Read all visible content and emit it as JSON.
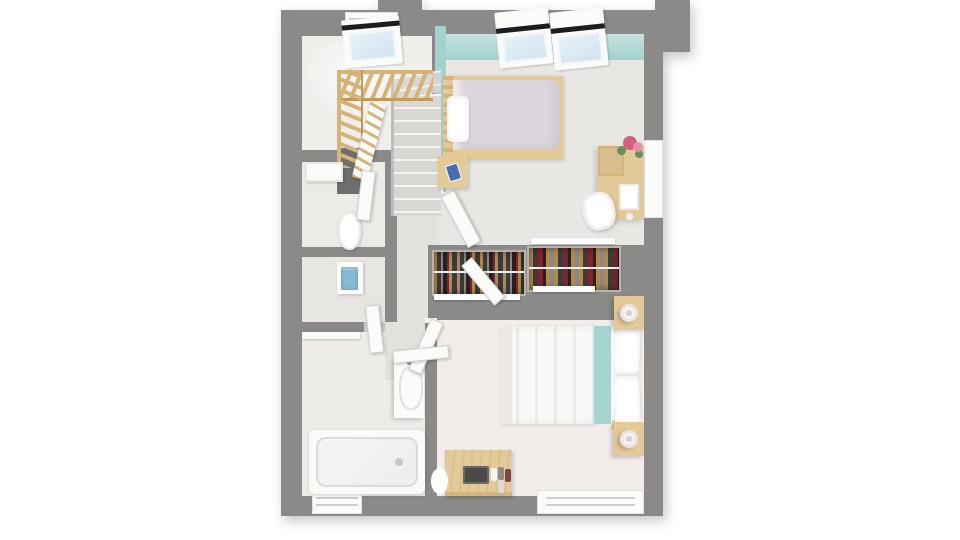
{
  "scene": {
    "type": "3d-floor-plan-top-view",
    "description": "Top-down 3D rendering of an upper floor: staircase, two bedrooms, WC, washroom, bathroom, hallway and built-in wardrobes",
    "background": "#ffffff"
  },
  "colors": {
    "page_bg": "#ffffff",
    "wall": "#8b8a88",
    "wall_void": "#6f6e6c",
    "teal": "#a2d2cd",
    "teal_light": "#c6e2de",
    "floor_stair": "#efeeeb",
    "floor_bed1": "#e9e7e4",
    "floor_hall": "#e2e1de",
    "floor_wc": "#ecebe8",
    "floor_wash": "#e8e6e3",
    "floor_bath": "#edece9",
    "floor_master": "#f2ecea",
    "wood": "#e4ca98",
    "wood_mid": "#d6b377",
    "wood_dark": "#c09a58",
    "white_obj": "#fbfbfa",
    "glass": "#cfe3ef",
    "sash_dark": "#1d1d1d",
    "tread": "#d8d7d4",
    "tread_edge": "#f4f4f2",
    "lilac": "#dcd5db",
    "duvet_white": "#f9f8f6",
    "blanket_teal": "#a6d4d2",
    "towel_blue": "#85bcd8",
    "phone_blue": "#4a6cb3",
    "flower_pink": "#d26180",
    "flower_pink2": "#e591a7",
    "leaf_green": "#67905c",
    "clothes_tan": "#b08a52",
    "clothes_dark": "#3e3a37",
    "clothes_red": "#822430",
    "clothes_gray": "#8d8781",
    "clothes_black": "#262220"
  },
  "rooms": [
    {
      "name": "staircase-room",
      "items": [
        "skylight",
        "wood-railing",
        "winding-stairs"
      ]
    },
    {
      "name": "wc",
      "items": [
        "toilet",
        "cistern-shelf",
        "door"
      ]
    },
    {
      "name": "washroom",
      "items": [
        "sink",
        "blue-towel",
        "shelf"
      ]
    },
    {
      "name": "hallway",
      "items": [
        "open-doors"
      ]
    },
    {
      "name": "bedroom-small",
      "items": [
        "single-bed",
        "nightstand-with-phone",
        "desk",
        "desk-chair",
        "flower-vase",
        "skylight-windows",
        "teal-accent-wall"
      ]
    },
    {
      "name": "wardrobe-niche",
      "items": [
        "wardrobe-left",
        "wardrobe-right",
        "sliding-door-tracks"
      ]
    },
    {
      "name": "bedroom-master",
      "items": [
        "double-bed",
        "teal-runner",
        "nightstand-lamp-top",
        "nightstand-lamp-bottom",
        "dresser",
        "perfume-bottles",
        "stool"
      ]
    },
    {
      "name": "bathroom",
      "items": [
        "bathtub",
        "vanity-sink"
      ]
    }
  ]
}
